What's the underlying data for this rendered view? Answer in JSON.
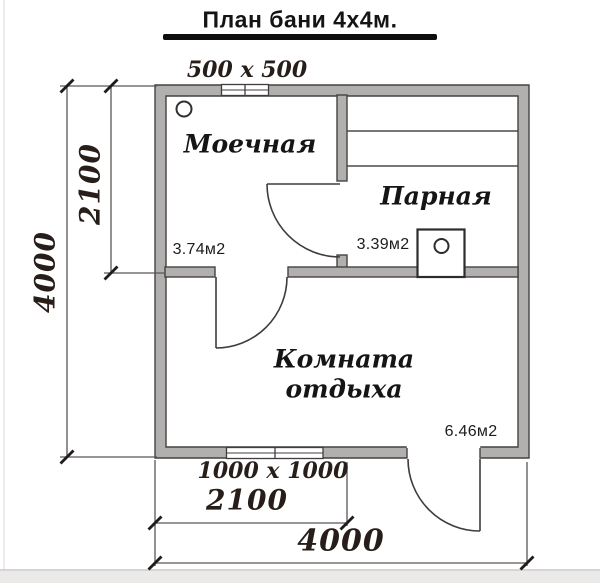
{
  "page": {
    "title": "План бани 4х4м."
  },
  "plan": {
    "rooms": [
      {
        "name": "Моечная",
        "area": "3.74м2"
      },
      {
        "name": "Парная",
        "area": "3.39м2"
      },
      {
        "name": "Комната отдыха",
        "area": "6.46м2"
      }
    ],
    "windows": {
      "top_label": "500 x 500",
      "bottom_label": "1000 x 1000"
    },
    "dimensions": {
      "left_upper": "2100",
      "left_total": "4000",
      "bottom_partial": "2100",
      "bottom_total": "4000"
    }
  },
  "colors": {
    "wall_fill": "#b2afaf",
    "wall_outline": "#454141",
    "dimension_text": "#271d19",
    "title_underline": "#0e0e0e"
  }
}
